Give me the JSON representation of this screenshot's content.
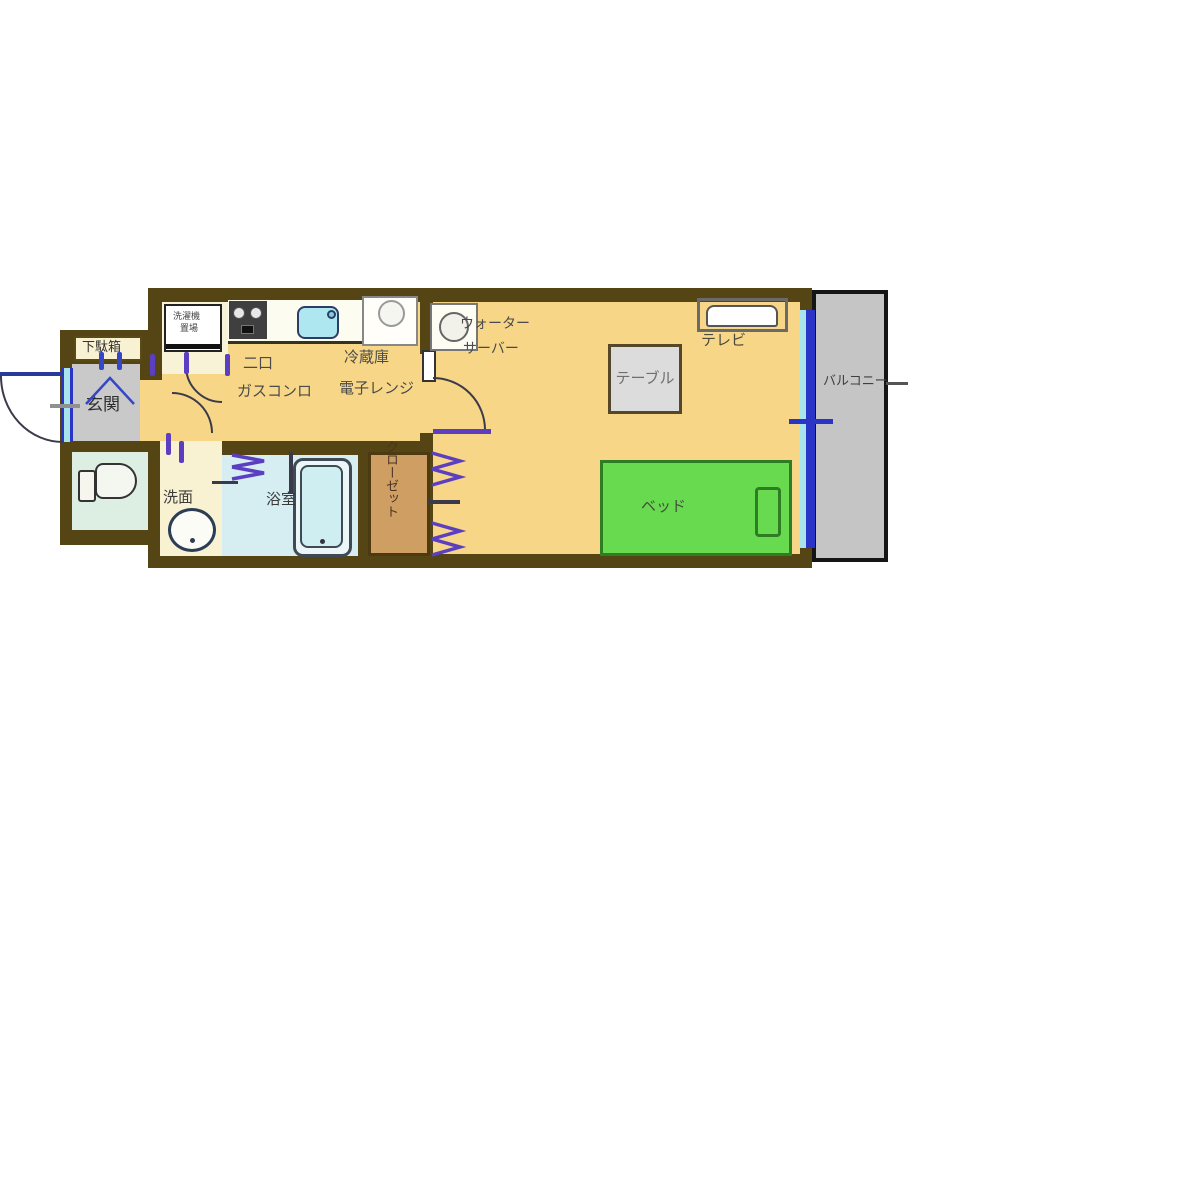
{
  "plan": {
    "rooms": {
      "getabako": "下駄箱",
      "genkan": "玄関",
      "washroom": "洗面",
      "bathroom": "浴室",
      "closet": "クローゼット",
      "balcony": "バルコニー"
    },
    "fixtures": {
      "washing_machine_l1": "洗濯機",
      "washing_machine_l2": "置場",
      "stove_l1": "二口",
      "stove_l2": "ガスコンロ",
      "fridge_l1": "冷蔵庫",
      "fridge_l2": "電子レンジ",
      "water_server_l1": "ウォーター",
      "water_server_l2": "サーバー",
      "table": "テーブル",
      "tv": "テレビ",
      "bed": "ベッド"
    },
    "colors": {
      "wall": "#554414",
      "floor": "#f7d787",
      "cream": "#f9f2d2",
      "bath": "#d6eef1",
      "toilet_room": "#dcefe2",
      "genkan_gray": "#c9c9c9",
      "closet_tan": "#cf9e63",
      "bed_green": "#68da50",
      "bed_border": "#2e7d22",
      "balcony_gray": "#c5c5c5",
      "window_blue": "#2a35c8",
      "window_cyan": "#a8e4ee",
      "door_purple": "#5b3fc0",
      "table_gray": "#dcdcdc"
    }
  }
}
